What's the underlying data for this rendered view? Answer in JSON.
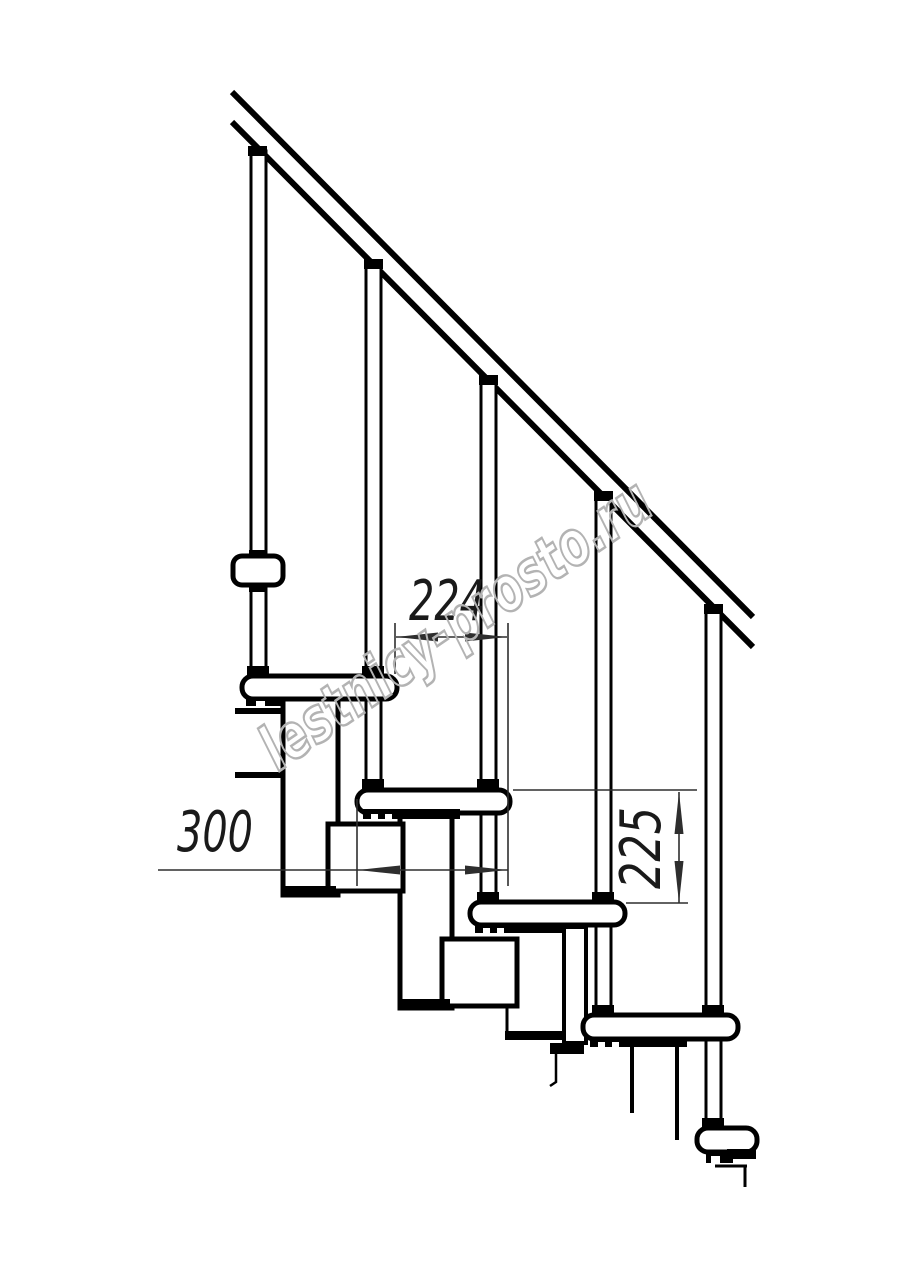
{
  "document": {
    "kind": "Technical line drawing — modular staircase, side elevation",
    "background": "#ffffff"
  },
  "colors": {
    "ink": "#000000",
    "dimension_lines": "#2e2e2e",
    "dimension_text": "#1a1a1a",
    "watermark": "#b3b3b3"
  },
  "watermark": {
    "text": "lestnicy-prosto.ru"
  },
  "dimensions": {
    "going": {
      "label": "224",
      "orientation": "horizontal"
    },
    "tread_depth": {
      "label": "300",
      "orientation": "horizontal"
    },
    "rise": {
      "label": "225",
      "orientation": "vertical"
    }
  },
  "structure": {
    "handrails": 1,
    "balusters": 5,
    "treads": 5
  }
}
